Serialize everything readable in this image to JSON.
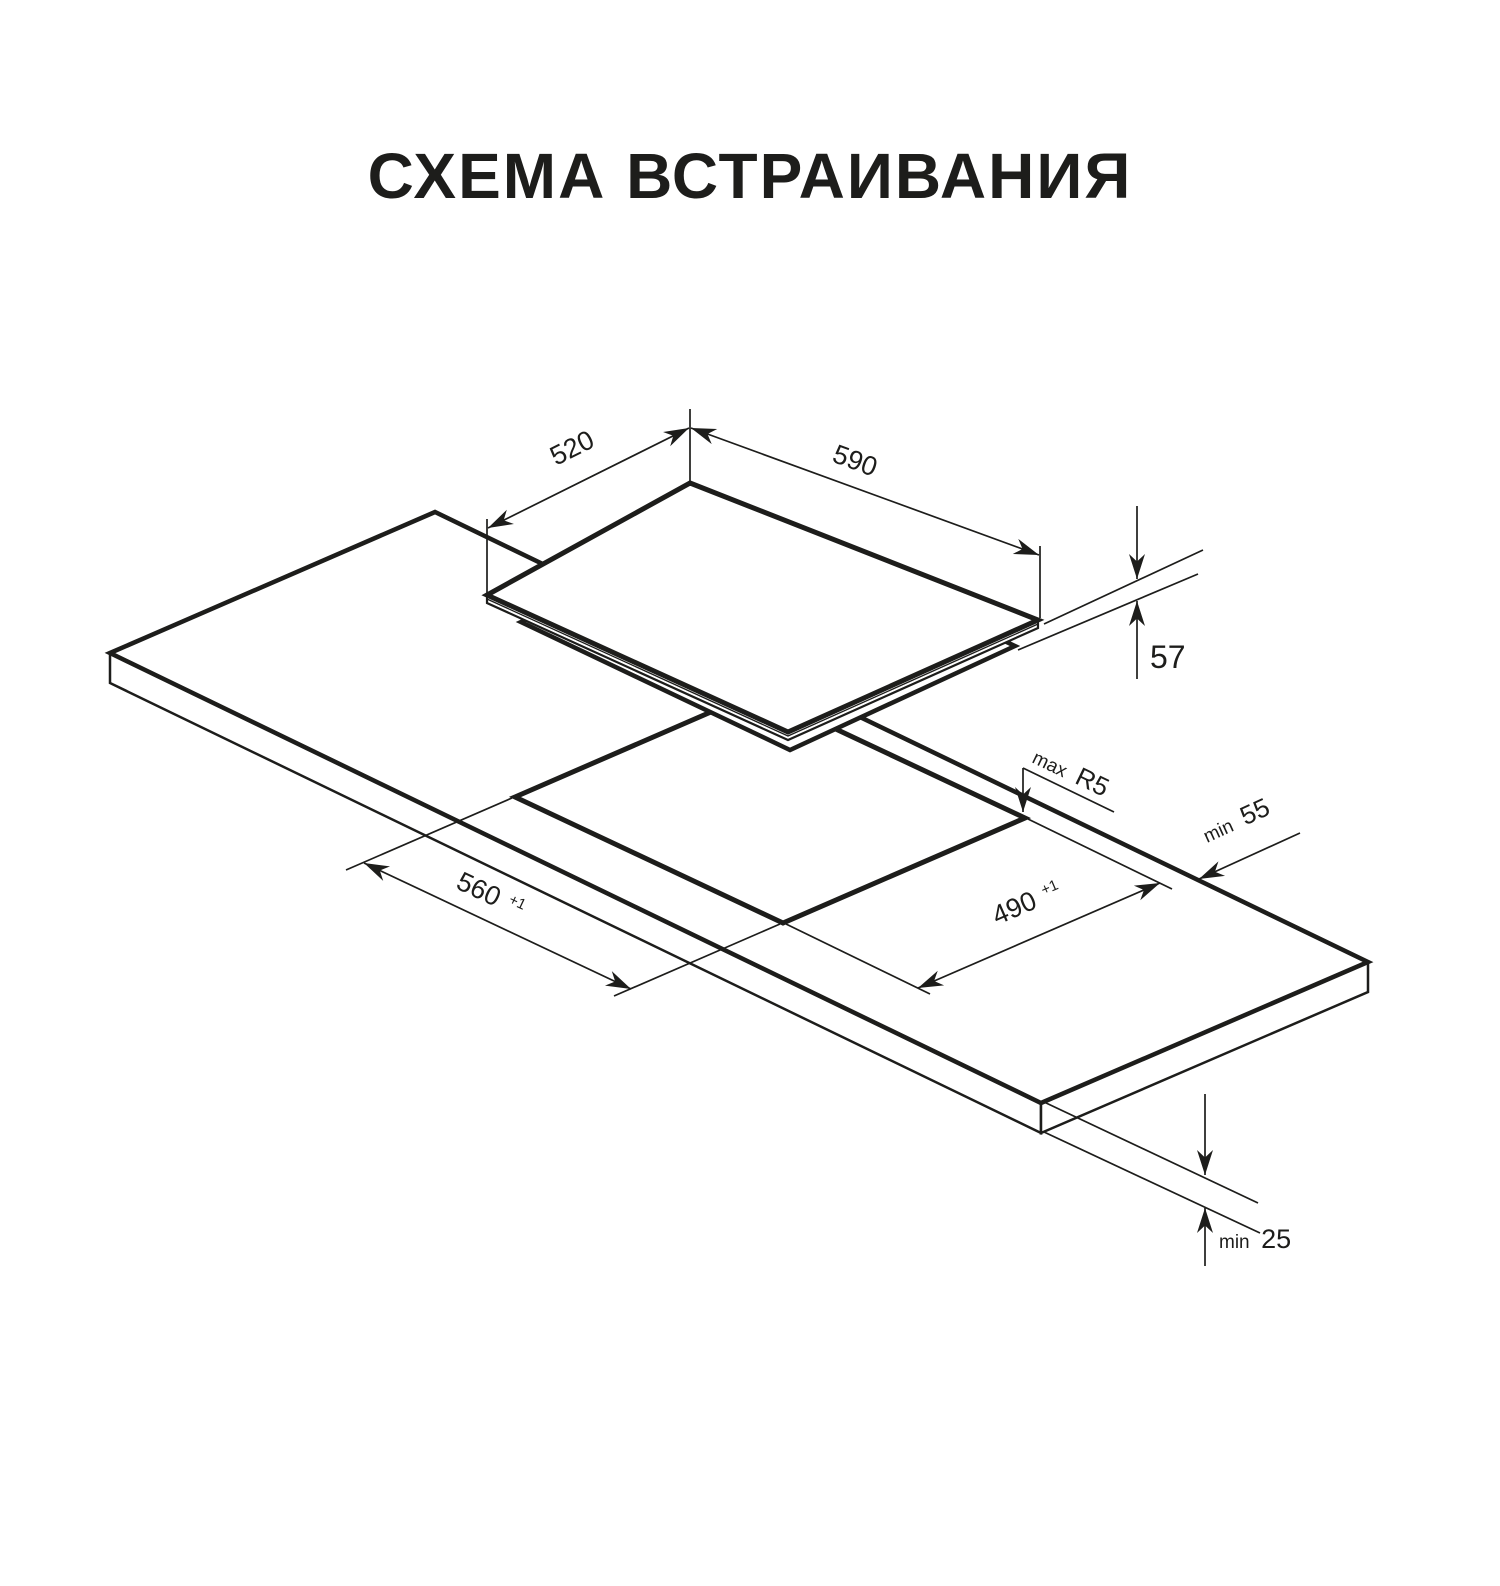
{
  "title": "СХЕМА ВСТРАИВАНИЯ",
  "diagram": {
    "kind": "isometric built-in hob installation drawing",
    "colors": {
      "line": "#1d1d1b",
      "background": "#ffffff",
      "title_text": "#1a1a1a"
    },
    "appliance": {
      "depth_label": "520",
      "width_label": "590",
      "height_label": "57"
    },
    "cutout": {
      "width_label": "560",
      "width_tolerance": "+1",
      "depth_label": "490",
      "depth_tolerance": "+1",
      "corner_radius_prefix": "max",
      "corner_radius_value": "R5",
      "edge_distance_prefix": "min",
      "edge_distance_value": "55",
      "worktop_thickness_prefix": "min",
      "worktop_thickness_value": "25"
    }
  }
}
